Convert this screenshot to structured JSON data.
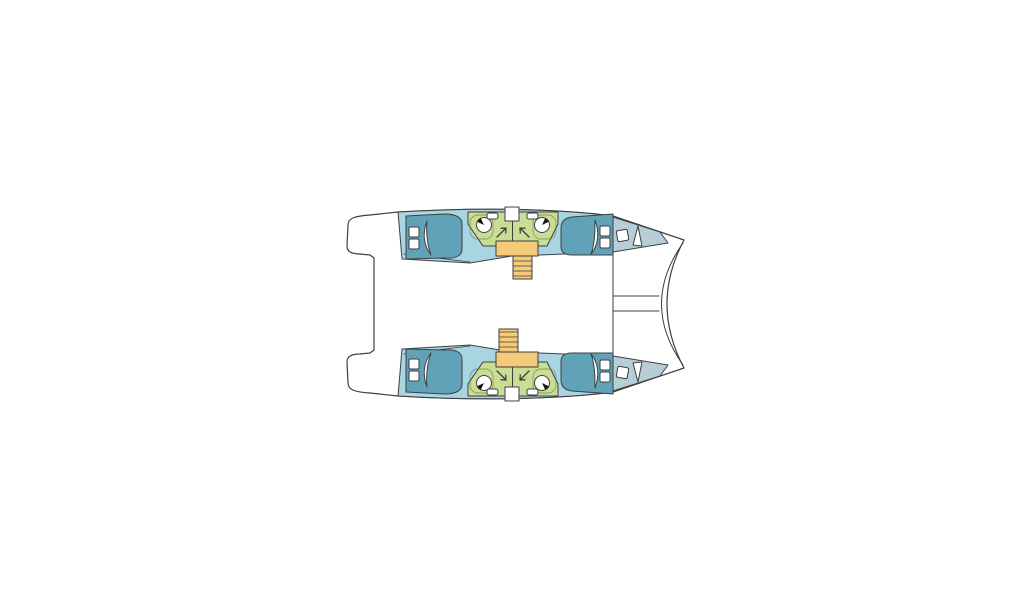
{
  "canvas": {
    "width": 1024,
    "height": 600,
    "background": "#ffffff"
  },
  "colors": {
    "outline": "#3f3f3f",
    "hull": "#a9d4e2",
    "bed": "#60a3b9",
    "bow_deck": "#b7ced6",
    "bathroom": "#c9dd94",
    "stairs": "#f5ca79",
    "white": "#ffffff",
    "fixture_black": "#141414",
    "background": "#ffffff"
  },
  "inventory": {
    "hulls": 2,
    "double_beds": 4,
    "pillows": 8,
    "washbasins": 4,
    "shower_symbols": 4,
    "staircases": 2,
    "stair_steps_per_flight": 5,
    "bow_deck_hatches": 2,
    "bathroom_doors": 2,
    "storage_shelves": 4
  }
}
